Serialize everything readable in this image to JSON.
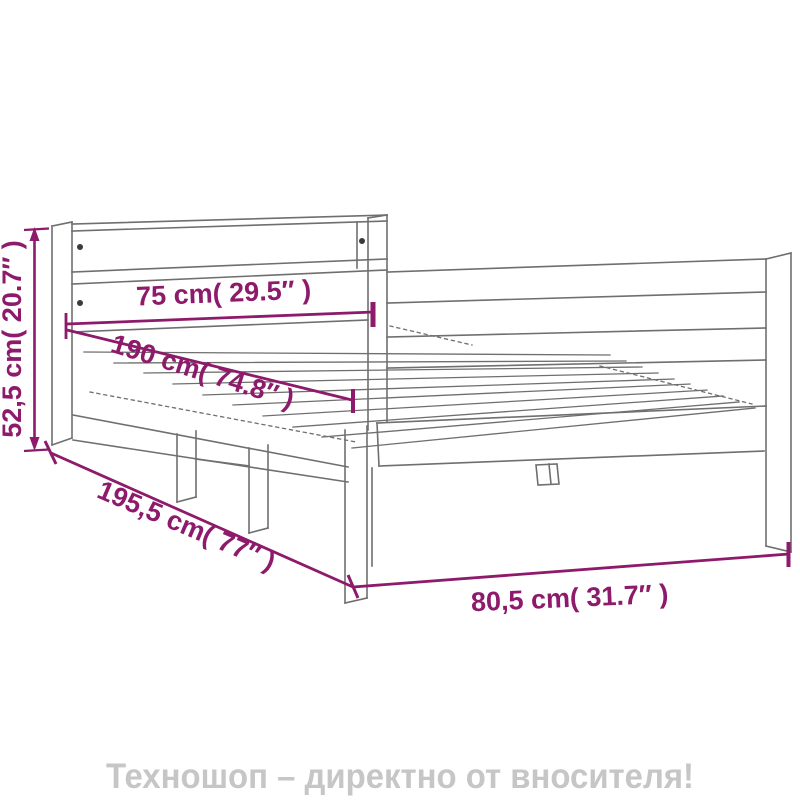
{
  "diagram": {
    "type": "product-dimension-drawing",
    "subject": "bed-frame-wireframe",
    "dimensions": {
      "height_left": "52,5 cm( 20.7″ )",
      "width_top": "75 cm( 29.5″ )",
      "length_inner": "190 cm( 74.8″ )",
      "length_total": "195,5 cm( 77″ )",
      "width_bottom": "80,5 cm( 31.7″ )"
    },
    "colors": {
      "dimension_accent": "#8D1A6A",
      "drawing_line": "#6f6f6f",
      "screw_dot": "#3a3a3a",
      "background": "#ffffff",
      "footer_text": "#c6c6c7"
    }
  },
  "footer": {
    "banner_text": "Техношоп – директно от вносителя!"
  }
}
